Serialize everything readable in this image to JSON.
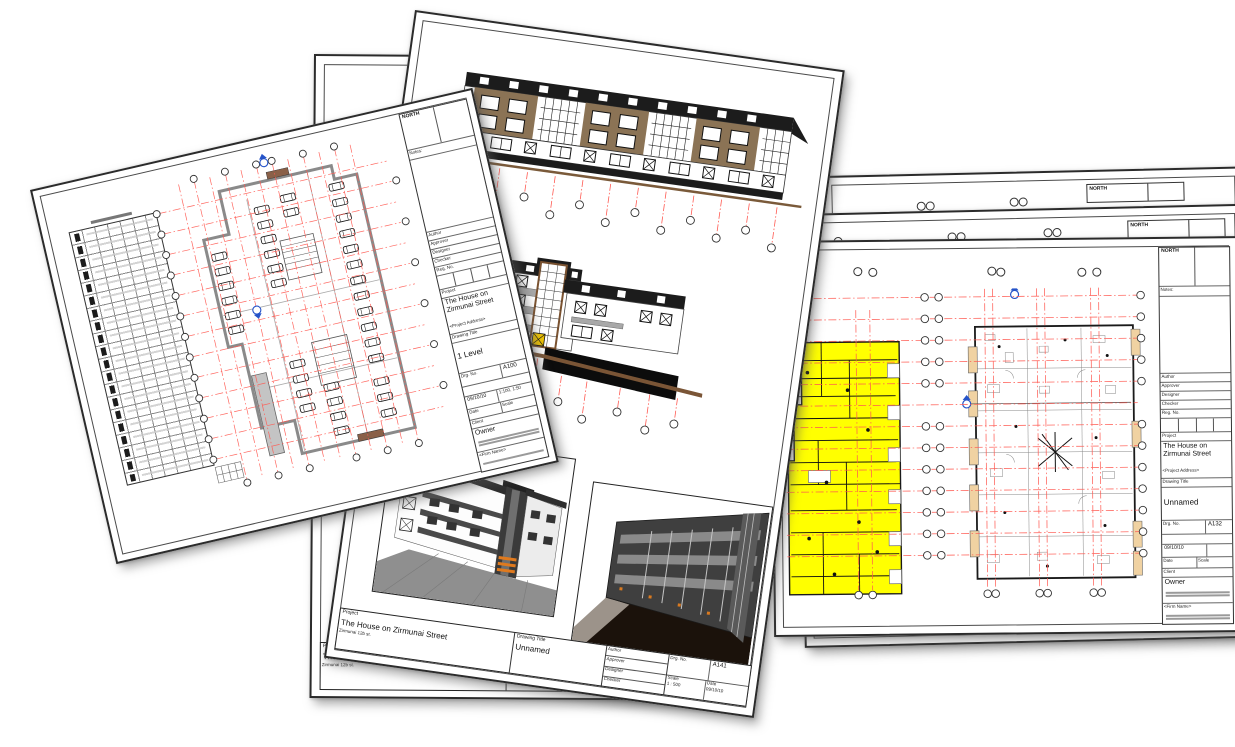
{
  "canvas": {
    "background": "#ffffff"
  },
  "labels": {
    "north": "NORTH",
    "notes": "Notes:",
    "project": "Project",
    "drawing_title": "Drawing Title",
    "drg_no": "Drg. No.",
    "reg_no": "Reg. No.",
    "date": "Date",
    "scale": "Scale",
    "client": "Client",
    "author": "Author",
    "approver": "Approver",
    "designer": "Designer",
    "checker": "Checker"
  },
  "project": {
    "name": "The House on Zirmunai Street",
    "address_placeholder": "<Project Address>",
    "street_address": "Zirmunai 12b st.",
    "client_name": "Owner",
    "firm_placeholder": "<Firm Name>"
  },
  "sheets": {
    "parking_plan": {
      "drawing_title": "1 Level",
      "drg_no": "A100",
      "date": "09/10/10",
      "scale": "1:100, 1:50"
    },
    "elevations": {
      "drawing_title": "Unnamed",
      "drg_no": "A141",
      "date": "09/10/10",
      "scale": "1 : 500"
    },
    "floor_plan": {
      "drawing_title": "Unnamed",
      "drg_no": "A132",
      "date": "09/10/10",
      "scale": ""
    },
    "back_bottom": {
      "drawing_title": "Unnamed"
    }
  },
  "colors": {
    "grid_line_red": "#ff5a52",
    "highlight_yellow": "#ffff00",
    "balcony_tan": "#f0d2a2",
    "facade_brown": "#8b7355",
    "roof_black": "#1c1c1c",
    "section_marker_blue": "#2553c8"
  }
}
